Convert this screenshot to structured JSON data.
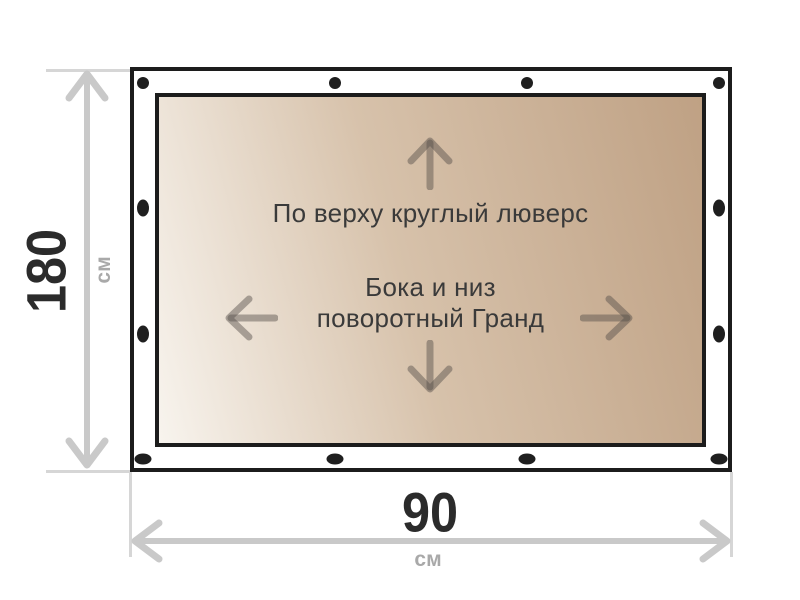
{
  "diagram": {
    "canvas_note_top": "По верху круглый люверс",
    "canvas_note_center_line1": "Бока и низ",
    "canvas_note_center_line2": "поворотный Гранд"
  },
  "dimensions": {
    "height": {
      "value": "180",
      "unit": "см"
    },
    "width": {
      "value": "90",
      "unit": "см"
    }
  },
  "grommets": {
    "top": {
      "shape": "circle",
      "count": 4
    },
    "bottom": {
      "shape": "oval-horizontal",
      "count": 4
    },
    "left": {
      "shape": "oval-vertical",
      "count": 2
    },
    "right": {
      "shape": "oval-vertical",
      "count": 2
    }
  },
  "colors": {
    "panel_border": "#1c1c1c",
    "grommet": "#1f1f1f",
    "canvas_gradient_start": "#f8f4ee",
    "canvas_gradient_mid": "#d7c2ab",
    "canvas_gradient_end": "#bfa184",
    "dimension_line": "#c9c9c9",
    "dimension_tick": "#d6d6d6",
    "dimension_value_text": "#2b2b2b",
    "dimension_unit_text": "#a9a9a9",
    "annotation_text": "#3a3a3a",
    "panel_arrow": "rgba(82,76,70,0.45)"
  }
}
